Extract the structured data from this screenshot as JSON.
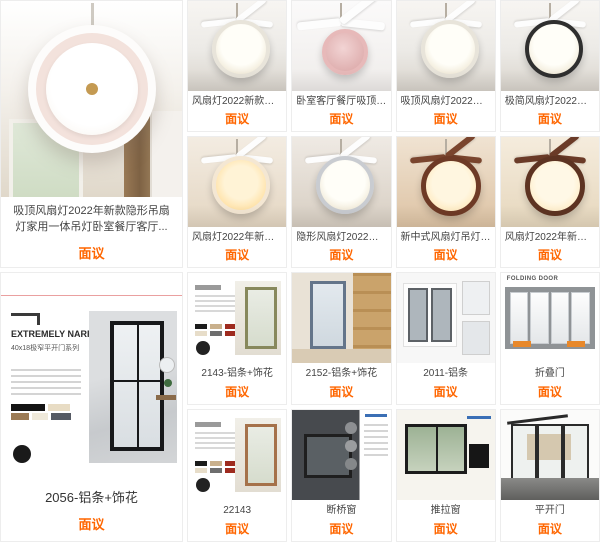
{
  "theme": {
    "accent": "#ff6600",
    "title_color": "#444444",
    "card_border": "#ededed"
  },
  "price_label": "面议",
  "sections": [
    {
      "name": "ceiling-fan-lights",
      "featured": {
        "title": "吸顶风扇灯2022年新款隐形吊扇灯家用一体吊灯卧室餐厅客厅...",
        "price": "面议"
      },
      "items": [
        {
          "title": "风扇灯2022新款灯家用吸...",
          "price": "面议"
        },
        {
          "title": "卧室客厅餐厅吸顶风扇灯..",
          "price": "面议"
        },
        {
          "title": "吸顶风扇灯2022年新款隐...",
          "price": "面议"
        },
        {
          "title": "极简风扇灯2022年新款隐...",
          "price": "面议"
        },
        {
          "title": "风扇灯2022年新款客厅隐...",
          "price": "面议"
        },
        {
          "title": "隐形风扇灯2022新款简约...",
          "price": "面议"
        },
        {
          "title": "新中式风扇灯吊灯客厅灯...",
          "price": "面议"
        },
        {
          "title": "风扇灯2022年新款隐形吊...",
          "price": "面议"
        }
      ]
    },
    {
      "name": "doors-and-windows",
      "featured": {
        "title": "2056-铝条+饰花",
        "price": "面议",
        "poster_heading": "EXTREMELY NARROW",
        "poster_subheading": "40x18极窄平开门系列"
      },
      "items": [
        {
          "title": "2143-铝条+饰花",
          "price": "面议"
        },
        {
          "title": "2152-铝条+饰花",
          "price": "面议"
        },
        {
          "title": "2011-铝条",
          "price": "面议"
        },
        {
          "title": "折叠门",
          "price": "面议",
          "poster_label": "FOLDING DOOR"
        },
        {
          "title": "22143",
          "price": "面议"
        },
        {
          "title": "断桥窗",
          "price": "面议"
        },
        {
          "title": "推拉窗",
          "price": "面议"
        },
        {
          "title": "平开门",
          "price": "面议"
        }
      ]
    }
  ]
}
